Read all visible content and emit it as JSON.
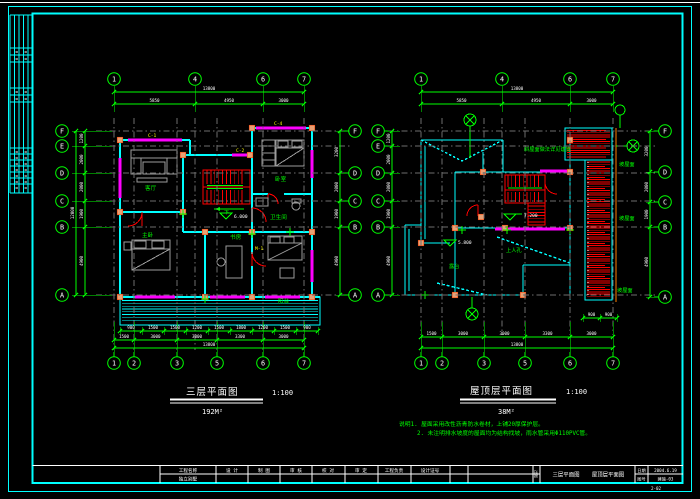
{
  "sheet": {
    "bg": "#000000"
  },
  "colors": {
    "frame": "#00FFFF",
    "wall": "#00FFFF",
    "axis": "#00FF00",
    "window": "#FF00FF",
    "stair": "#FF0000",
    "roofhatch": "#FF0000",
    "column": "#E8A074",
    "eave": "#FF8000",
    "furniture": "#9C9C9C",
    "gridline": "#6E6E6E",
    "text": "#FFFFFF",
    "tag": "#FFFF00"
  },
  "left_plan": {
    "title": "三层平面图",
    "scale": "1:100",
    "area": "192M²",
    "grid_top": [
      "1",
      "4",
      "6",
      "7"
    ],
    "grid_bottom": [
      "1",
      "2",
      "3",
      "5",
      "6",
      "7"
    ],
    "grid_left": [
      "F",
      "E",
      "D",
      "C",
      "B",
      "A"
    ],
    "grid_right": [
      "F",
      "D",
      "C",
      "B",
      "A"
    ],
    "dim_top_overall": [
      "13800"
    ],
    "dim_top_segments": [
      "5850",
      "4950",
      "3000"
    ],
    "dim_bottom_detail": [
      "900",
      "1500",
      "1500",
      "1200",
      "1500",
      "1800",
      "1200",
      "1500",
      "900"
    ],
    "dim_bottom_segments": [
      "1500",
      "3000",
      "3000",
      "3300",
      "3000"
    ],
    "dim_bottom_overall": [
      "13800"
    ],
    "dim_left_segments": [
      "1200",
      "2000",
      "2000",
      "1900",
      "4900"
    ],
    "dim_left_overall": [
      "12000"
    ],
    "dim_right_segments": [
      "3200",
      "2000",
      "1900",
      "4900"
    ],
    "rooms": {
      "living": "客厅",
      "bed1": "卧室",
      "bath": "卫生间",
      "study": "书房",
      "master": "主卧",
      "balcony": "阳台",
      "stair_dir": "下"
    },
    "window_tags": [
      "C-1",
      "C-4",
      "C-2",
      "M-1"
    ],
    "level": "6.000"
  },
  "right_plan": {
    "title": "屋顶层平面图",
    "scale": "1:100",
    "area": "38M²",
    "grid_top": [
      "1",
      "4",
      "6",
      "7"
    ],
    "grid_bottom": [
      "1",
      "2",
      "3",
      "5",
      "6",
      "7"
    ],
    "grid_left": [
      "F",
      "E",
      "D",
      "C",
      "B",
      "A"
    ],
    "grid_right": [
      "F",
      "D",
      "C",
      "B",
      "A"
    ],
    "dim_top_overall": [
      "13800"
    ],
    "dim_top_segments": [
      "5850",
      "4950",
      "3000"
    ],
    "dim_bottom_segments": [
      "1500",
      "3000",
      "3000",
      "3300",
      "3000"
    ],
    "dim_bottom_overall": [
      "13800"
    ],
    "dim_left_segments": [
      "1200",
      "2000",
      "2000",
      "1900",
      "4900"
    ],
    "dim_right_segments": [
      "3200",
      "2000",
      "1900",
      "4900"
    ],
    "dim_strip": [
      "900",
      "900"
    ],
    "labels": {
      "slope1": "坡屋面",
      "slope2": "坡屋面",
      "slope3": "坡屋面",
      "roof_note": "斜屋面做法详见建施",
      "access": "上人孔",
      "terrace": "露台"
    },
    "levels": [
      "7.200",
      "5.800"
    ],
    "notes": [
      "说明1. 屋面采用改性沥青防水卷材，上铺20厚保护层。",
      "2. 未注明排水坡度的屋面均为结构找坡，雨水管采用Φ110PVC管。"
    ]
  },
  "titleblock": {
    "fields": [
      {
        "label": "工程名称",
        "value": "独立别墅"
      },
      {
        "label": "设 计",
        "value": ""
      },
      {
        "label": "制 图",
        "value": ""
      },
      {
        "label": "审 核",
        "value": ""
      },
      {
        "label": "校 对",
        "value": ""
      },
      {
        "label": "审 定",
        "value": ""
      },
      {
        "label": "工程负责",
        "value": ""
      },
      {
        "label": "设计证号",
        "value": ""
      }
    ],
    "stamp": "出图",
    "drawing_names": [
      "三层平面图",
      "屋顶层平面图"
    ],
    "date_label": "日期",
    "date": "2004.6.19",
    "no_label": "图号",
    "no": "建施-03",
    "page": "2-02"
  }
}
